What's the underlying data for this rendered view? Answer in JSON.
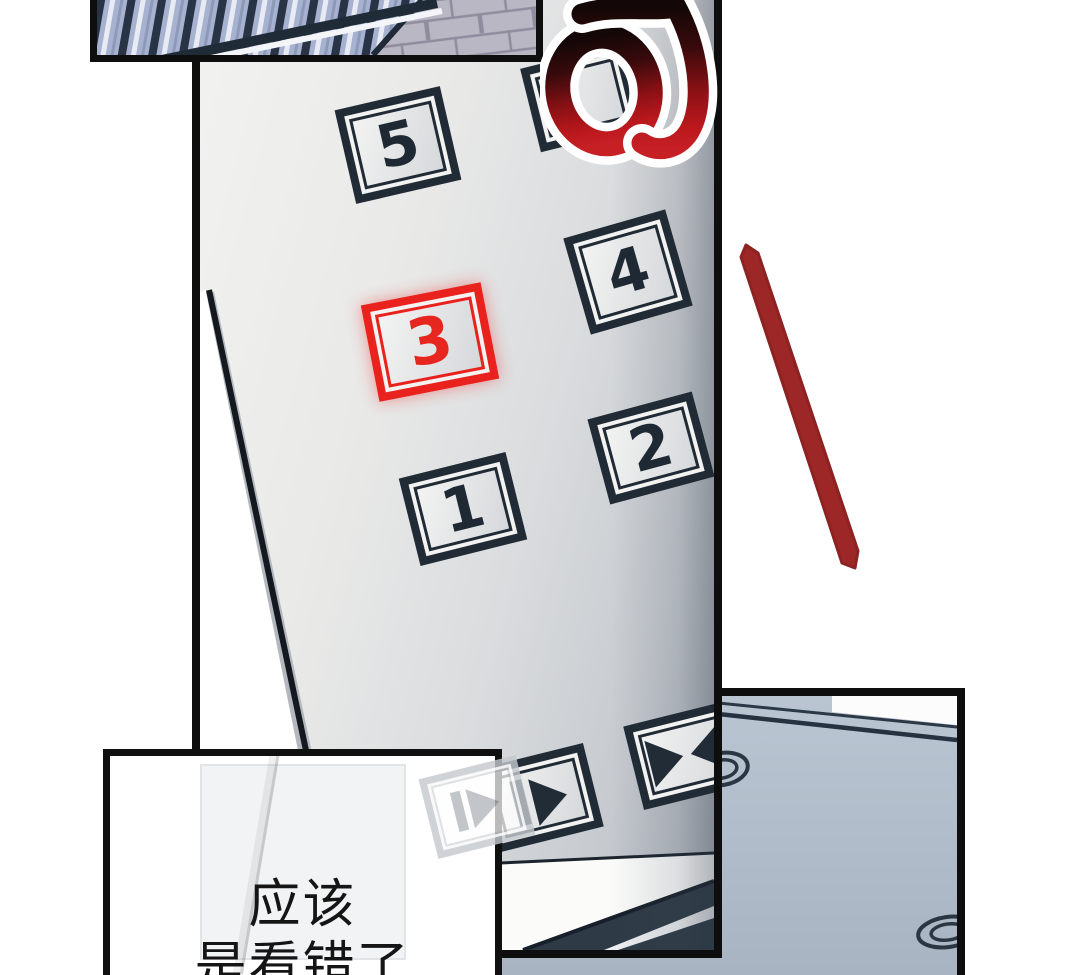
{
  "scene": {
    "background": "#ffffff",
    "description": "comic page: elevator button panel with floor 3 lit"
  },
  "sfx": {
    "text": "叮",
    "color_top": "#140707",
    "color_bottom": "#c62025"
  },
  "main": {
    "buttons": [
      {
        "label": "5",
        "highlighted": false
      },
      {
        "label": "4",
        "highlighted": false
      },
      {
        "label": "3",
        "highlighted": true
      },
      {
        "label": "2",
        "highlighted": false
      },
      {
        "label": "1",
        "highlighted": false
      }
    ],
    "partial_button": {
      "label": ""
    },
    "door_buttons": [
      {
        "icon": "arrows-facing"
      },
      {
        "icon": "bar-and-arrow-right"
      }
    ],
    "highlight_color": "#e9221e",
    "frame_color": "#212b36"
  },
  "caption": {
    "lines": [
      "应该",
      "是看错了"
    ]
  },
  "colors": {
    "stroke_red": "#9c2726",
    "floor_blue_gray": "#b5c0ce",
    "railing_blue": "#a7b2d0",
    "brick": "#b9b7c3"
  }
}
